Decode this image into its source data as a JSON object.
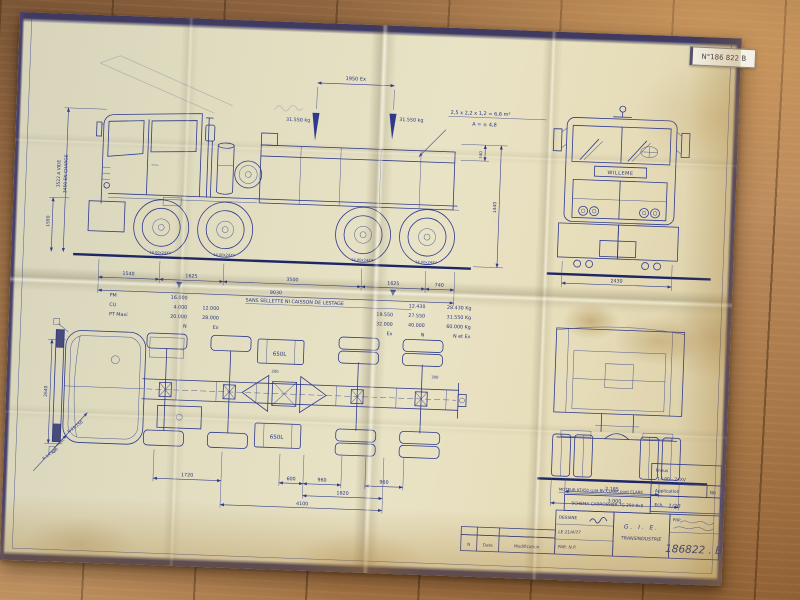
{
  "sticker": {
    "label": "N°186 822 B"
  },
  "colors": {
    "ink": "#2e3a8e",
    "paper": "#e9e3c6",
    "floor": "#a87a4c"
  },
  "side_view": {
    "dim_top": "1950 Ex",
    "load_left": "31.550 kg",
    "load_right": "31.550 kg",
    "note_volume": "2,5 x 2,2 x 1,2 = 6,6 m³",
    "note_area": "A = ± 4,8",
    "height_empty": "3522 A VIDE",
    "height_loaded": "3450 EN CHARGE",
    "dim_1590": "1590",
    "dim_340": "340",
    "dim_1440": "1440",
    "tire": "14.00x24XV",
    "dims": [
      "1540",
      "1625",
      "3500",
      "1625",
      "740"
    ],
    "dim_total": "9030"
  },
  "weights_table": {
    "note": "SANS SELLETTE NI CAISSON DE LESTAGE",
    "rows": [
      {
        "label": "PM",
        "a": "16.000",
        "b": "",
        "c": "",
        "d": "12.430",
        "e": "28.430 Kg"
      },
      {
        "label": "CU",
        "a": "4.000",
        "b": "12.000",
        "c": "19.550",
        "d": "27.550",
        "e": "31.550 Kg"
      },
      {
        "label": "PT Maxi",
        "a": "20.000",
        "b": "28.000",
        "c": "32.000",
        "d": "40.000",
        "e": "60.000 Kg"
      },
      {
        "label": "",
        "a": "N",
        "b": "Ex",
        "c": "Ex",
        "d": "N",
        "e": "N et Ex"
      }
    ]
  },
  "front_view": {
    "brand": "WILLEME",
    "dim_width": "2430"
  },
  "plan_view": {
    "tank_top": "650L",
    "tank_bottom": "650L",
    "dim_left": "2640",
    "radius_1": "R 13.150",
    "radius_2": "R 14.300",
    "dim_200": "200",
    "dim_300": "300",
    "dims_bottom": [
      "1720",
      "600",
      "960",
      "960"
    ],
    "dim_mid": "1820",
    "dim_total": "4100"
  },
  "lower_front_view": {
    "dim_track": "2.185",
    "dim_width": "3.000"
  },
  "title_block": {
    "pneus_label": "Pneus",
    "pneus_value": "14.00 - 24XV",
    "application": "Application",
    "nb": "Nb",
    "ech": "Ech.",
    "ech_value": "1/20",
    "moteur": "MOTEUR KT450 cplé BV CLARK pont CLARK",
    "schema": "SCHEMA CARROSSIER TG 250 8x8",
    "dessine": "DESSINE",
    "date": "LE 21/4/77",
    "par": "PAR: N.P.",
    "company_1": "G. I. E.",
    "company_2": "TRANSINDUSTRIE",
    "prp": "PRP",
    "number": "186822 . B"
  },
  "revision_strip": {
    "n": "N",
    "date": "Date",
    "modification": "Modification"
  }
}
